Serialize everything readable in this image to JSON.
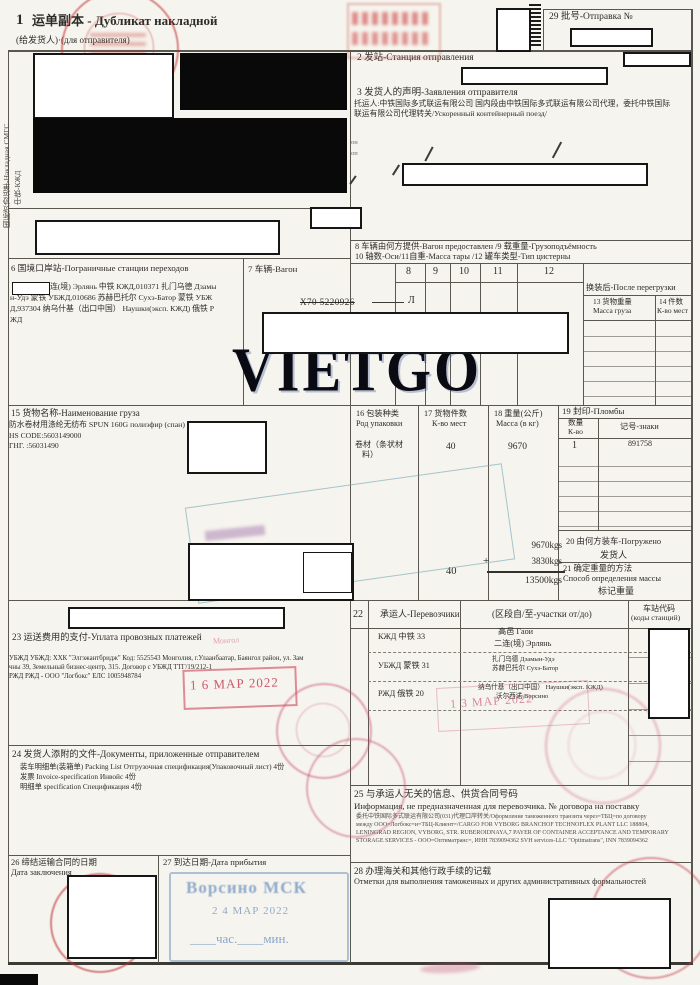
{
  "margin": {
    "l1": "国际货协运单-Накладная СМГС",
    "l2": "中铁-КЖД"
  },
  "b1": {
    "num": "1",
    "zh": "运单副本 -",
    "ru": "Дубликат накладной",
    "sub": "(给发货人)·(для отправителя)"
  },
  "b29": {
    "label": "29 批号-Отправка №"
  },
  "b2": {
    "label": "2 发站-Станция отправления"
  },
  "b3": {
    "label": "3 发货人的声明-Заявления отправителя",
    "l1": "托运人:中铁国际多式联运有限公司 国内段由中铁国际多式联运有限公司代理，委托中铁国际",
    "l2": "联运有限公司代理转关/Ускоренный контейнерный поезд/"
  },
  "fragments": {
    "f1": "он",
    "f2": "оп"
  },
  "b6": {
    "label": "6 国境口岸站-Пограничные станции переходов",
    "l1": "连(境) Эрлянь 中铁 КЖД,010371 扎门乌德 Дзамы",
    "l2": "н-Удэ 蒙铁 УБЖД,010686 苏赫巴托尔 Сухэ-Батор 蒙铁 УБЖ",
    "l3": "Д,937304 纳乌什基（出口中国） Наушки(эксп. КЖД) 俄铁 Р",
    "l4": "ЖД"
  },
  "b7": {
    "label": "7 车辆-Вагон",
    "wagon": "X70 5220926",
    "mark": "Л"
  },
  "b8": {
    "l1": "8  车辆由何方提供-Вагон предоставлен   /9   载重量-Грузоподъёмность",
    "l2": "10 轴数-Оси/11自重-Масса тары              /12 罐车类型-Тип цистерны",
    "cols": [
      "8",
      "9",
      "10",
      "11",
      "12"
    ]
  },
  "b13": {
    "header": "换装后-После перегрузки",
    "c13a": "13 货物重量",
    "c13b": "Масса груза",
    "c14a": "14 件数",
    "c14b": "К-во мест"
  },
  "b15": {
    "label": "15 货物名称-Наименование груза",
    "l1": "防水卷材用涤纶无纺布 SPUN 160G полиэфир (спан) 1",
    "l2": "HS CODE:5603149000",
    "l3": "ГНГ. :56031490"
  },
  "b16": {
    "la": "16 包装种类",
    "lb": "Род упаковки",
    "v1": "卷材（条状材",
    "v2": "料）"
  },
  "b17": {
    "la": "17 货物件数",
    "lb": "К-во мест",
    "value": "40",
    "value2": "40"
  },
  "b18": {
    "la": "18 重量(公斤)",
    "lb": "Масса (в кг)",
    "value": "9670",
    "sum1": "9670kgs",
    "plus": "+",
    "sum2": "3830kgs",
    "total": "13500kgs"
  },
  "b19": {
    "label": "19 封印-Пломбы",
    "qty_a": "数量",
    "qty_b": "К-во",
    "marks_label": "记号-знаки",
    "qty": "1",
    "marks": "891758"
  },
  "b20": {
    "label": "20 由何方装车-Погружено",
    "value": "发货人"
  },
  "b21": {
    "l1": "21 确定重量的方法",
    "l2": "Способ определения массы",
    "value": "标记重量"
  },
  "b22": {
    "num": "22",
    "carrier": "承运人-Перевозчики",
    "section": "(区段自/至-участки от/до)",
    "codes_a": "车站代码",
    "codes_b": "(коды станций)",
    "rows": [
      {
        "carrier": "КЖД 中铁 33",
        "from": "高邑 Гаои",
        "to": "二连(境) Эрлянь"
      },
      {
        "carrier": "УБЖД 蒙铁 31",
        "from": "扎门乌德 Дзамын-Удэ",
        "to": "苏赫巴托尔 Сухэ-Батор"
      },
      {
        "carrier": "РЖД 俄铁 20",
        "from": "纳乌什基（出口中国） Наушки(эксп. КЖД)",
        "to": "沃尔西诺 Ворсино"
      }
    ]
  },
  "b23": {
    "label": "23 运送费用的支付-Уплата провозных платежей",
    "l1": "УБЖД УБЖД: ХХК \"Элгэжантбридж\" Код: 5525543 Монголия, г.Улаанбаатар, Баянгол район, ул. Зам",
    "l2": "чны 39, Земельный бизнес-центр, 315. Договор с УБЖД ТТГ/19/212-1",
    "l3": "РЖД РЖД - ООО \"Логбокс\" ЕЛС 1005948784"
  },
  "b24": {
    "label": "24 发货人添附的文件-Документы, приложенные отправителем",
    "l1": "装车明细单(装箱单) Packing List Отгрузочная спецификация(Упаковочный лист) 4份",
    "l2": "发票 Invoice-specification Инвойс 4份",
    "l3": "明细单 specification Спецификация 4份"
  },
  "b25": {
    "label_zh": "25 与承运人无关的信息、供货合同号码",
    "label_ru": "Информация, не предназначенная для перевозчика. № договора на поставку",
    "l1": "委托中铁国际多式联运有限公司(031)代理口岸转关/Оформление таможенного транзита через=ТБЦ=по договору",
    "l2": "между ООО=Логбокс=и=ТБЦ-Клиент=/CARGO FOR VYBORG BRANCHOF TECHNOFLEX PLANT LLC 188804,",
    "l3": "LENINGRAD REGION, VYBORG, STR. RUBEROIDNAYA,7 PAYER OF CONTAINER ACCEPTANCE AND TEMPORARY",
    "l4": "STORAGE SERVICES - ООО=Оптиматранс=, ИНН 7839094362 SVH services-LLC \"Optimatrans\", INN 7839094362"
  },
  "b26": {
    "l1": "26 缔结运输合同的日期",
    "l2": "Дата заключения"
  },
  "b27": {
    "label": "27 到达日期-Дата прибытия"
  },
  "b28": {
    "l1": "28 办理海关和其他行政手续的记载",
    "l2": "Отметки для выполнения таможенных и других административных формальностей"
  },
  "stamps": {
    "date1": "1 6  МАР  2022",
    "date2": "1 3  МАР  2022",
    "arrival_station": "Ворсино МСК",
    "arrival_date": "2 4  МАР 2022",
    "arrival_time": "____час.____мин.",
    "fragment": "Монгол"
  },
  "watermark": "VIETGO"
}
